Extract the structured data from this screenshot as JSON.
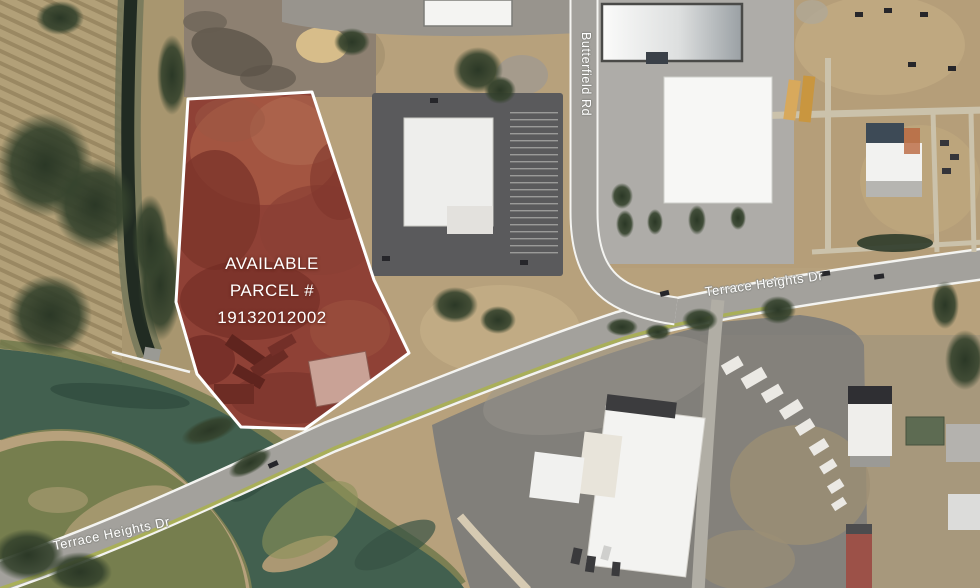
{
  "map": {
    "kind": "satellite-aerial-parcel-highlight",
    "parcel": {
      "label_lines": [
        "AVAILABLE",
        "PARCEL #",
        "19132012002"
      ],
      "parcel_number": "19132012002",
      "highlight_fill": "#8e4136",
      "outline_color": "#ffffff"
    },
    "roads": [
      {
        "name": "Butterfield Rd",
        "orientation": "vertical"
      },
      {
        "name": "Terrace Heights Dr",
        "orientation": "diagonal-east"
      },
      {
        "name": "Terrace Heights Dr",
        "orientation": "diagonal-southwest"
      }
    ],
    "colors": {
      "water": "#42604f",
      "scrub": "#b2a078",
      "dirt": "#bda887",
      "road": "#a3a19c",
      "roof_white": "#f2f2f0"
    }
  }
}
